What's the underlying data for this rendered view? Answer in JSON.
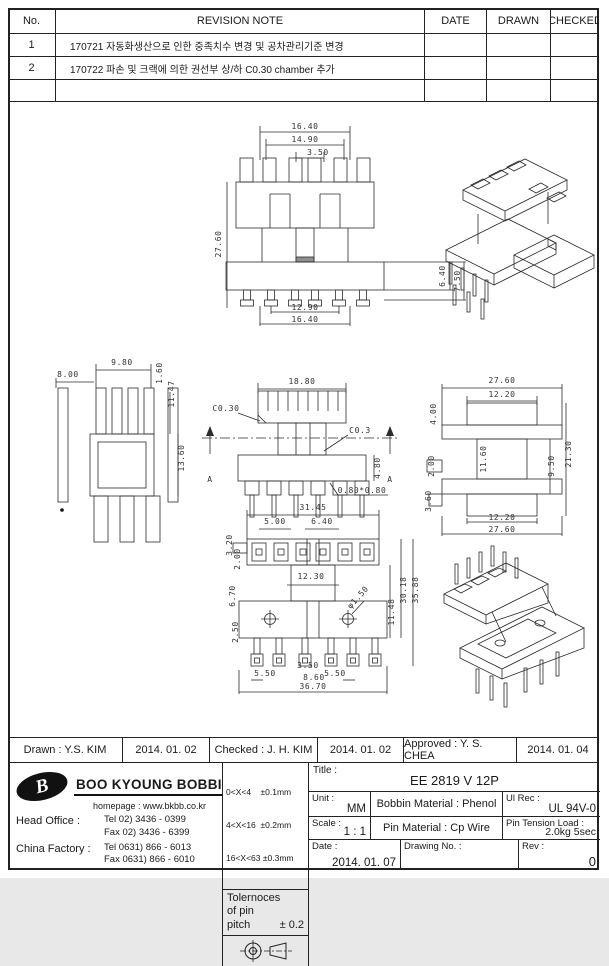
{
  "revision_table": {
    "headers": {
      "no": "No.",
      "note": "REVISION  NOTE",
      "date": "DATE",
      "drawn": "DRAWN",
      "checked": "CHECKED"
    },
    "rows": [
      {
        "no": "1",
        "note": "170721 자동화생산으로 인한 중족치수 변경 및 공차관리기준 변경"
      },
      {
        "no": "2",
        "note": "170722 파손 및 크랙에 의한 권선부 상/하 C0.30 chamber 추가"
      },
      {
        "no": "",
        "note": ""
      }
    ]
  },
  "drawings": {
    "front_view": [
      "16.40",
      "14.90",
      "3.50",
      "27.60",
      "6.40",
      "7.50",
      "12.90",
      "16.40"
    ],
    "side_view": [
      "9.80",
      "8.00",
      "1.60",
      "11.47",
      "13.60"
    ],
    "section_view": [
      "18.80",
      "C0.30",
      "C0.3",
      "4.80",
      "0.80*0.80",
      "A"
    ],
    "profile_view": [
      "27.60",
      "12.20",
      "4.00",
      "2.00",
      "3.60",
      "11.60",
      "9.50",
      "21.30",
      "12.20",
      "27.60"
    ],
    "bottom_view": [
      "31.45",
      "5.00",
      "6.40",
      "3.20",
      "2.00",
      "12.30",
      "6.70",
      "2.50",
      "11.48",
      "30.18",
      "35.88",
      "φ1.50",
      "5.50",
      "3.50",
      "8.60",
      "5.50",
      "36.70"
    ]
  },
  "signatures": {
    "drawn": "Drawn : Y.S. KIM",
    "drawn_date": "2014. 01. 02",
    "checked": "Checked : J. H. KIM",
    "checked_date": "2014. 01. 02",
    "approved": "Approved : Y. S. CHEA",
    "approved_date": "2014. 01. 04"
  },
  "company": {
    "logo_letter": "B",
    "name": "BOO KYOUNG BOBBIN",
    "homepage": "homepage : www.bkbb.co.kr",
    "head_office_label": "Head Office :",
    "head_office_tel": "Tel   02) 3436 - 0399",
    "head_office_fax": "Fax   02) 3436 - 6399",
    "china_factory_label": "China Factory :",
    "china_factory_tel": "Tel   0631) 866 - 6013",
    "china_factory_fax": "Fax   0631) 866 - 6010"
  },
  "tolerances": {
    "ranges": [
      "0<X<4    ±0.1mm",
      "4<X<16  ±0.2mm",
      "16<X<63 ±0.3mm"
    ],
    "pitch_line1": "Tolernoces",
    "pitch_line2": "of pin",
    "pitch_line3": "pitch",
    "pitch_value": "± 0.2"
  },
  "title_block": {
    "title_label": "Title :",
    "title_value": "EE 2819 V 12P",
    "unit_label": "Unit :",
    "unit_value": "MM",
    "bobbin_material": "Bobbin Material : Phenol",
    "ul_rec_label": "Ul Rec :",
    "ul_rec_value": "UL 94V-0",
    "scale_label": "Scale :",
    "scale_value": "1 : 1",
    "pin_material": "Pin Material : Cp Wire",
    "pin_tension_label": "Pin Tension Load :",
    "pin_tension_value": "2.0kg 5sec",
    "date_label": "Date :",
    "date_value": "2014. 01. 07",
    "drawing_no_label": "Drawing No.  :",
    "rev_label": "Rev :",
    "rev_value": "0"
  }
}
